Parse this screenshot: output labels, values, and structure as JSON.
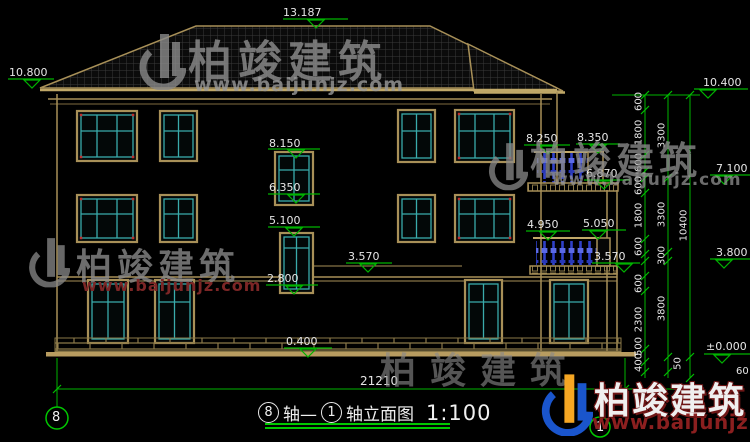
{
  "watermarks": {
    "brand": "柏竣建筑",
    "url": "www.baijunjz.com"
  },
  "title": {
    "axis_from": "8",
    "axis_sep": "轴—",
    "axis_to": "1",
    "axis_suffix": "轴立面图",
    "scale": "1:100"
  },
  "axes": {
    "left": "8",
    "right": "1"
  },
  "levels": {
    "ridge": "13.187",
    "left_eave": "10.800",
    "right_eave": "10.400",
    "stair_upper_head": "8.150",
    "stair_upper_sill": "6.350",
    "stair_lower_head": "5.100",
    "stair_lower_sill": "2.800",
    "mid_slab": "3.570",
    "terrace_left": "8.250",
    "terrace_right": "8.350",
    "wing_eave": "6.870",
    "balcony_left": "4.950",
    "balcony_right": "5.050",
    "balcony_slab": "3.570",
    "floor3": "7.100",
    "floor2": "3.800",
    "ground": "±0.000",
    "plinth": "0.400"
  },
  "dimensions": {
    "overall_width": "21210",
    "chain_floors": [
      "600",
      "1800",
      "600",
      "600",
      "1800",
      "600",
      "600",
      "2300",
      "500",
      "400"
    ],
    "chain_levels": [
      "3300",
      "3300",
      "300",
      "3800"
    ],
    "chain_total": [
      "10400"
    ],
    "small": [
      "50",
      "60"
    ]
  }
}
